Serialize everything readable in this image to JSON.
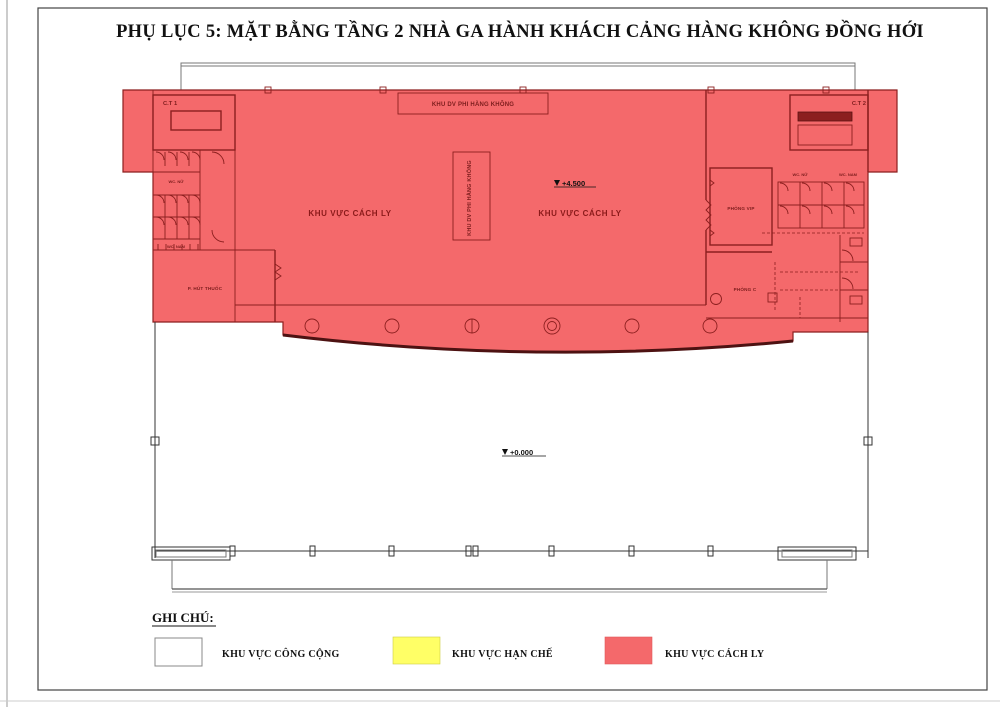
{
  "page": {
    "title": "PHỤ LỤC 5: MẶT BẰNG TẦNG 2 NHÀ GA HÀNH KHÁCH CẢNG HÀNG KHÔNG ĐỒNG HỚI"
  },
  "plan": {
    "areas": {
      "isolation_left_label": "KHU VỰC CÁCH LY",
      "isolation_right_label": "KHU VỰC CÁCH LY",
      "non_aviation_service_top": "KHU DV PHI HÀNG KHÔNG",
      "non_aviation_service_vertical": "KHU DV PHI HÀNG KHÔNG"
    },
    "rooms": {
      "stair_1": "C.T 1",
      "stair_2": "C.T 2",
      "wc_female_left": "WC. NỮ",
      "wc_male_left": "WC. NAM",
      "wc_female_right": "WC. NỮ",
      "wc_male_right": "WC. NAM",
      "smoking_room": "P. HÚT THUỐC",
      "vip_room": "PHÒNG VIP",
      "room_c": "PHÒNG C"
    },
    "levels": {
      "floor2": "+4.500",
      "ground": "+0.000"
    },
    "colors": {
      "isolation_fill": "#f4696b",
      "isolation_line": "#8c1f1f",
      "restricted_fill": "#ffff66",
      "public_fill": "#ffffff",
      "outline": "#333333"
    }
  },
  "legend": {
    "heading": "GHI CHÚ:",
    "items": [
      {
        "label": "KHU VỰC CÔNG CỘNG",
        "color": "#ffffff"
      },
      {
        "label": "KHU VỰC HẠN CHẾ",
        "color": "#ffff66"
      },
      {
        "label": "KHU VỰC CÁCH LY",
        "color": "#f4696b"
      }
    ]
  }
}
